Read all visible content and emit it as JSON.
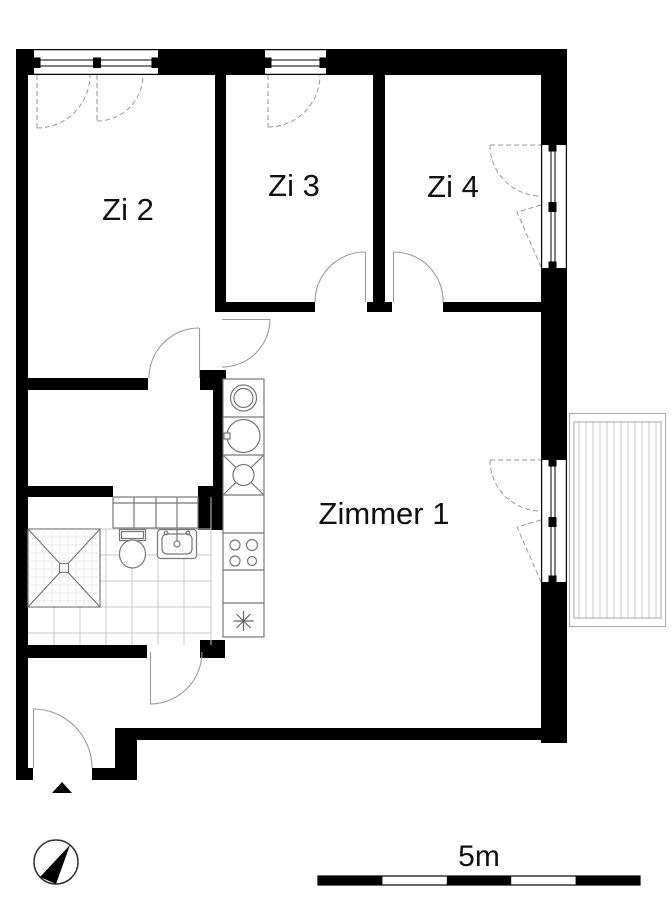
{
  "plan": {
    "type": "apartment-floor-plan",
    "rooms": [
      {
        "id": "zi2",
        "label": "Zi 2"
      },
      {
        "id": "zi3",
        "label": "Zi 3"
      },
      {
        "id": "zi4",
        "label": "Zi 4"
      },
      {
        "id": "zimmer1",
        "label": "Zimmer 1"
      }
    ],
    "scale_bar": {
      "label": "5m",
      "segments": 5,
      "meters_per_segment": 1
    },
    "compass": "north-arrow",
    "entrance_marker": "triangle-arrow",
    "fixtures": [
      "shower",
      "toilet",
      "washbasin",
      "bathroom-cupboard",
      "washing-machine",
      "kitchen-sink",
      "dishwasher",
      "stove",
      "fridge-freezer",
      "balcony"
    ]
  },
  "colors": {
    "wall": "#000000",
    "background": "#ffffff",
    "door_swing": "#9a9a9a",
    "fixture_line": "#777777",
    "tile_line": "#c8c8c8",
    "balcony_line": "#aaaaaa",
    "text": "#111111"
  }
}
